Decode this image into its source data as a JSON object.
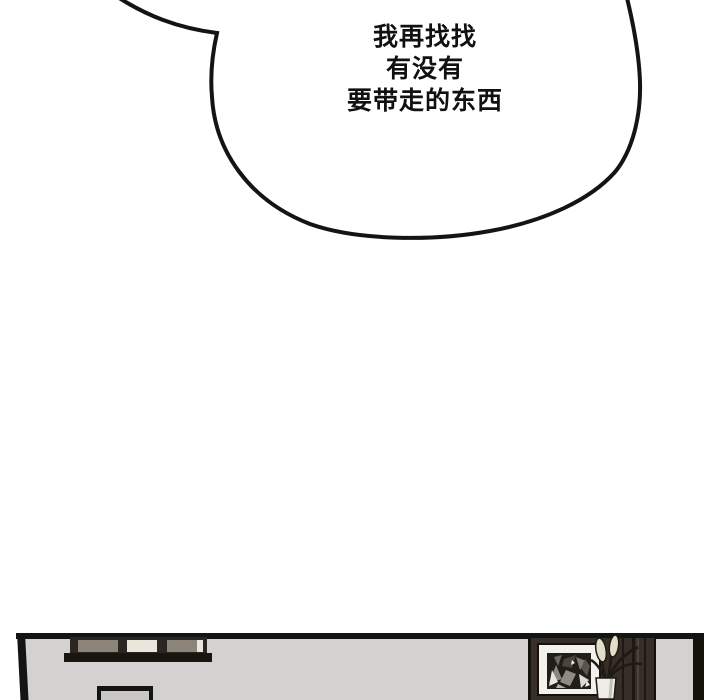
{
  "bubble": {
    "lines": [
      "我再找找",
      "有没有",
      "要带走的东西"
    ]
  },
  "colors": {
    "background": "#ffffff",
    "line": "#141414",
    "bubble_fill": "#ffffff",
    "text": "#111111",
    "wall": "#d3d2d0",
    "window_frame": "#2c2620",
    "window_panel_taupe": "#8d8479",
    "window_panel_cream": "#eae6dc",
    "window_sliver": "#e9e6df",
    "window_ledge": "#18140f",
    "tv_screen": "#c9c8c5",
    "furniture_wood": "#372f27",
    "furniture_edge": "#15110c",
    "furniture_grain_dark": "#1d1811",
    "furniture_grain_light": "#4d4339",
    "picture_mat": "#f3f1ec",
    "artwork_background": "#211e19",
    "plant_leaf": "#e3decb",
    "plant_stem": "#1f1a14",
    "vase": "#efede8",
    "vase_shade": "#c2bfb9"
  }
}
